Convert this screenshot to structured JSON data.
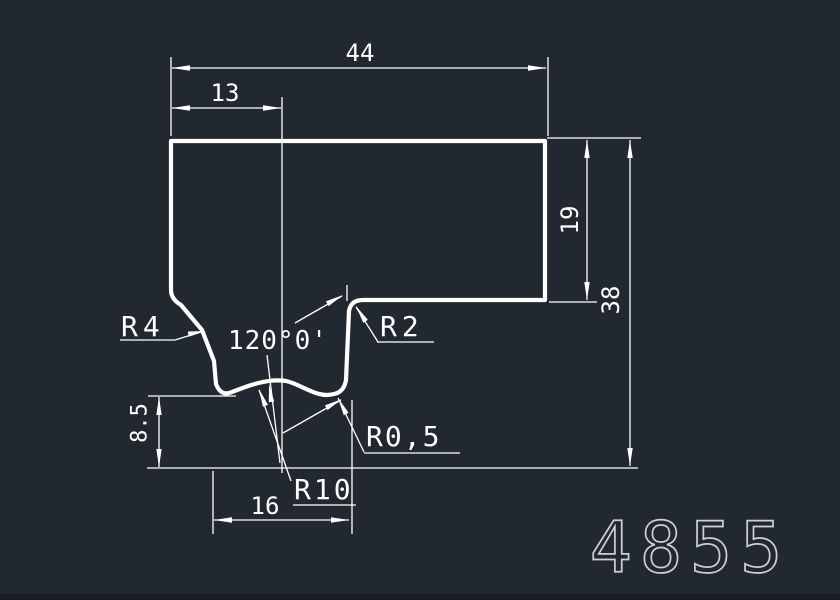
{
  "drawing": {
    "part_number": "4855",
    "colors": {
      "background": "#212830",
      "line": "#ffffff",
      "part_number_stroke": "#ccd1d6"
    },
    "labels": {
      "dim_overall_width": "44",
      "dim_left_offset": "13",
      "dim_right_height": "19",
      "dim_overall_height": "38",
      "dim_notch_depth": "8.5",
      "dim_notch_width": "16",
      "angle_notch": "120°0'",
      "radius_top_left": "R4",
      "radius_top_right": "R2",
      "radius_small": "R0,5",
      "radius_bottom": "R10"
    }
  }
}
